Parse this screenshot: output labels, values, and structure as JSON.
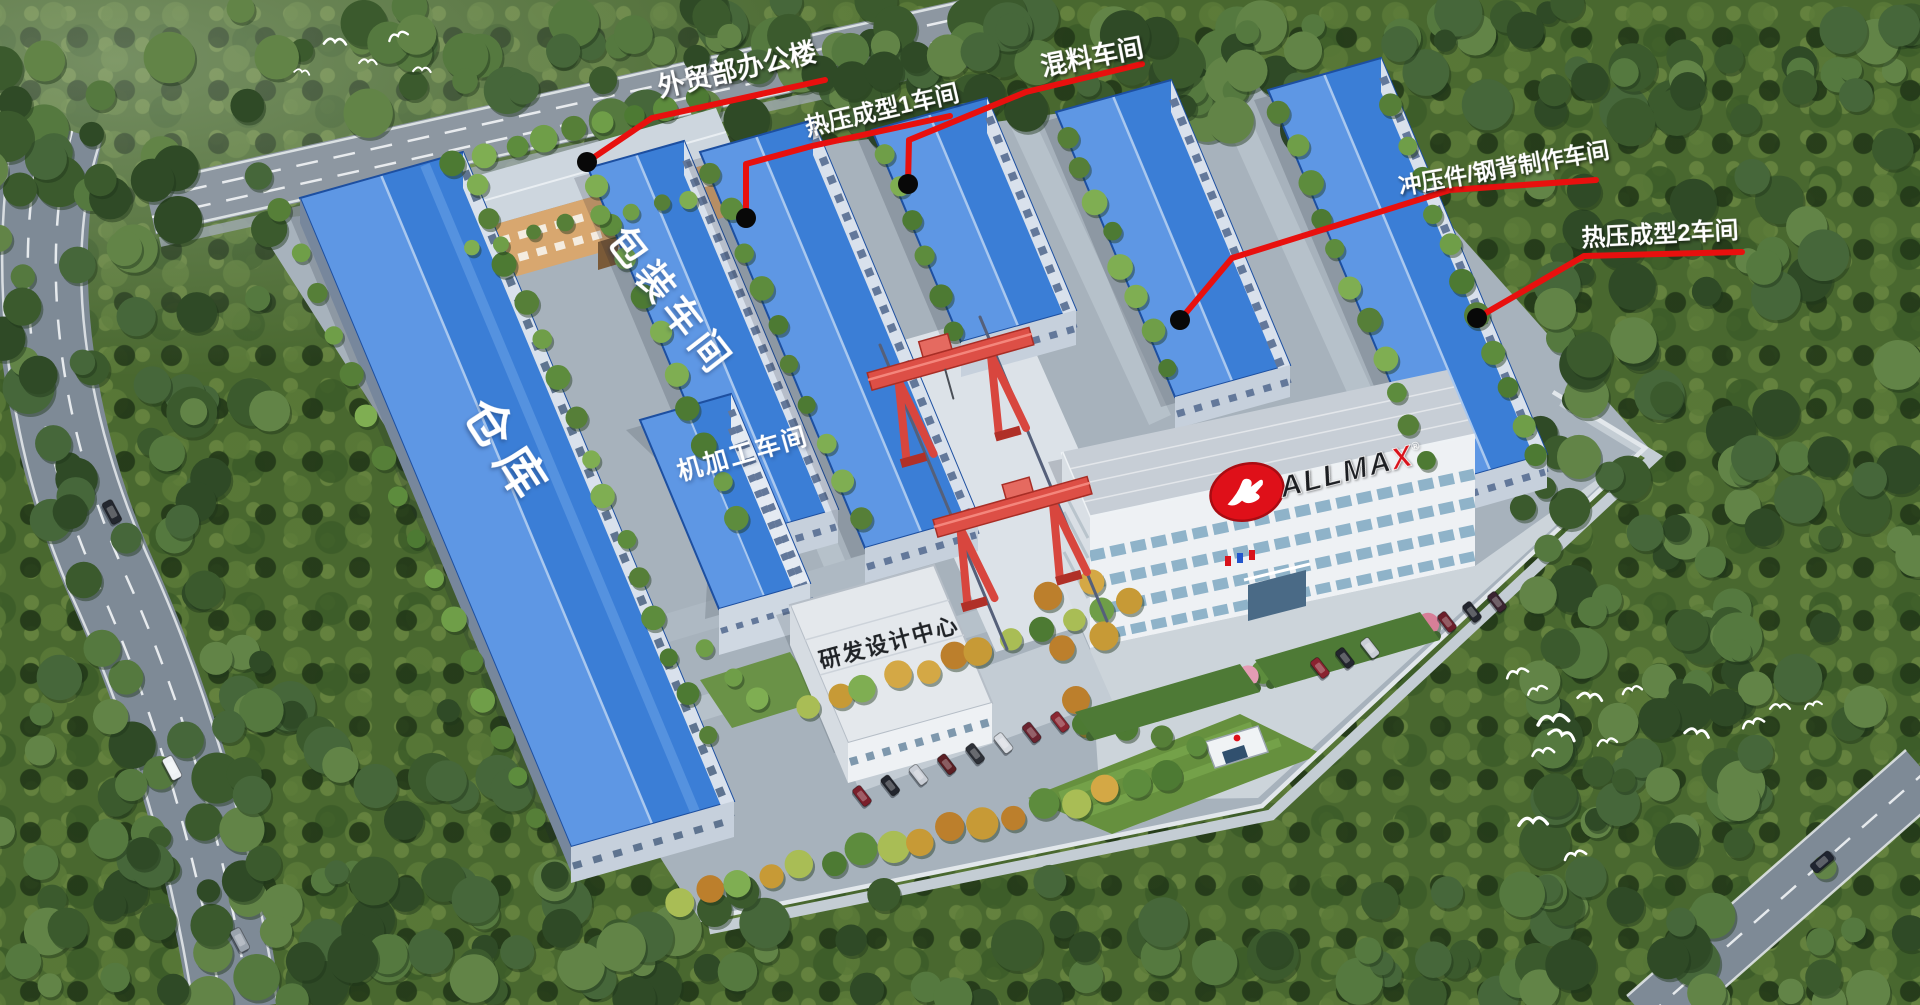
{
  "callouts": {
    "office": {
      "label": "外贸部办公楼"
    },
    "hot_press_1": {
      "label": "热压成型1车间"
    },
    "mixing": {
      "label": "混料车间"
    },
    "stamping": {
      "label": "冲压件/钢背制作车间"
    },
    "hot_press_2": {
      "label": "热压成型2车间"
    }
  },
  "roof_labels": {
    "packaging": "包装车间",
    "warehouse": "仓库",
    "machining": "机加工车间",
    "rnd": "研发设计中心"
  },
  "hq": {
    "logo_text": "ALLMAX",
    "registered": "®"
  },
  "colors": {
    "callout_red": "#e8100e",
    "callout_dot": "#080808",
    "label_white": "#ffffff",
    "roof_blue": "#3b7ed6",
    "roof_blue_light": "#5e97e4",
    "logo_red": "#df1019",
    "forest_green": "#49682f",
    "road_gray": "#7e8a96",
    "campus_gray": "#a7b2bc"
  }
}
